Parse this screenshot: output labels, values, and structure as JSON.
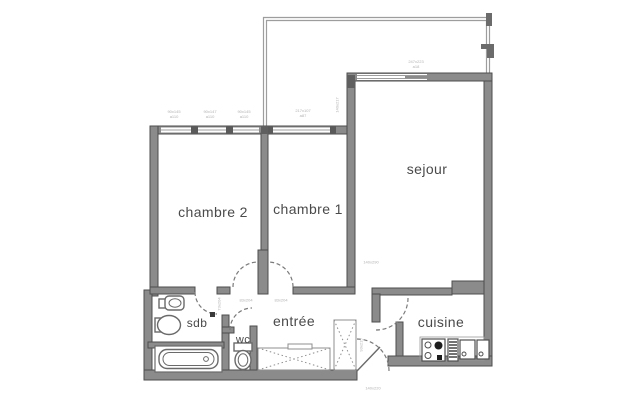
{
  "title": "apartment-floor-plan",
  "colors": {
    "background": "#ffffff",
    "wall_fill": "#8b8b8b",
    "wall_stroke": "#4e4e4e",
    "thin_line": "#9d9d9d",
    "door_arc": "#7a7a7a",
    "fixture_stroke": "#6a6a6a",
    "room_text": "#4a4a4a",
    "dim_text": "#b2b2b2"
  },
  "rooms": {
    "chambre2": {
      "label": "chambre 2"
    },
    "chambre1": {
      "label": "chambre 1"
    },
    "sejour": {
      "label": "sejour"
    },
    "sdb": {
      "label": "sdb"
    },
    "entree": {
      "label": "entrée"
    },
    "wc": {
      "label": "wc"
    },
    "cuisine": {
      "label": "cuisine"
    }
  },
  "dimensions": {
    "d1": {
      "text": "90x145\na110"
    },
    "d2": {
      "text": "90x147\na110"
    },
    "d3": {
      "text": "90x145\na110"
    },
    "d4": {
      "text": "217x107\na87"
    },
    "d5": {
      "text": "247x223\na18"
    },
    "d6": {
      "text": "140x217"
    },
    "d7": {
      "text": "83x204"
    },
    "d8": {
      "text": "83x204"
    },
    "d9": {
      "text": "73x204"
    },
    "d10": {
      "text": "140x220"
    },
    "d11": {
      "text": "93x215"
    },
    "d12": {
      "text": "140x290"
    }
  },
  "fixtures": [
    "bathtub",
    "washbasin",
    "round-basin",
    "toilet",
    "stove",
    "drainer",
    "kitchen-sink-double",
    "closet-entree",
    "closet-hall",
    "balcony-railing"
  ]
}
